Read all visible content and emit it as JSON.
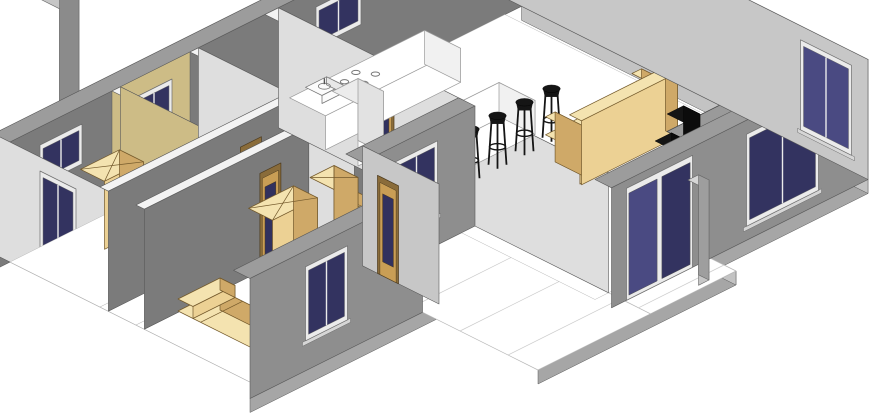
{
  "figure": {
    "type": "isometric-3d-floor-plan-render",
    "background": "#ffffff"
  },
  "colors": {
    "background": "#ffffff",
    "edge": "#5a5a5a",
    "wall_top": "#9c9c9c",
    "partition_top": "#f3f3f3",
    "ext_south": "#8e8e8e",
    "ext_east": "#c7c7c7",
    "int_dark": "#7b7b7b",
    "int_light": "#dedede",
    "tan_wall": "#cdbc86",
    "floor": "#ffffff",
    "floor_line": "#b8b8b8",
    "slab_south": "#a6a6a6",
    "slab_east": "#c3c3c3",
    "glass_dark": "#333360",
    "glass_mid": "#4a4a82",
    "frame_light": "#ebebeb",
    "frame_stroke": "#6e6e6e",
    "door_frame": "#8a6c3a",
    "door_leaf": "#c99e55",
    "door_glass": "#31315e",
    "furn_front": "#ecd194",
    "furn_side": "#cfa968",
    "furn_top": "#f4e3b0",
    "furn_outline": "#73592b",
    "black": "#151515",
    "table_top": "#9a9a9a",
    "table_edge": "#6a6a6a",
    "fixture": "#fbfbfb",
    "fixture_side": "#e8e8e8",
    "chimney_front": "#a9a9a9",
    "chimney_side": "#8b8b8b",
    "chimney_top": "#c6c6c6",
    "column_top": "#d6d6d6",
    "column_front": "#c6c6c6",
    "column_side": "#9e9e9e"
  },
  "scene": {
    "rooms": [
      "bedroom-1",
      "bedroom-2",
      "bedroom-3",
      "bathroom",
      "wc",
      "corridor",
      "kitchen-living-room",
      "terrace"
    ],
    "openings": [
      "exterior-windows",
      "interior-glazed-doors",
      "sliding-glass-door",
      "terrace-door",
      "clerestory-window-slots"
    ],
    "furniture": [
      "beds",
      "wardrobes",
      "kitchen-counter",
      "kitchen-island",
      "refrigerator",
      "kitchen-sink",
      "cooktop-symbol",
      "bar-stools",
      "sofa",
      "dining-table",
      "dining-chairs",
      "bathroom-fixtures"
    ],
    "structures": [
      "chimney",
      "terrace-column",
      "floor-slab"
    ],
    "counts": {
      "bar_stools": 4,
      "dining_chairs": 4,
      "bedrooms": 3,
      "sofa_seats": 3
    }
  }
}
